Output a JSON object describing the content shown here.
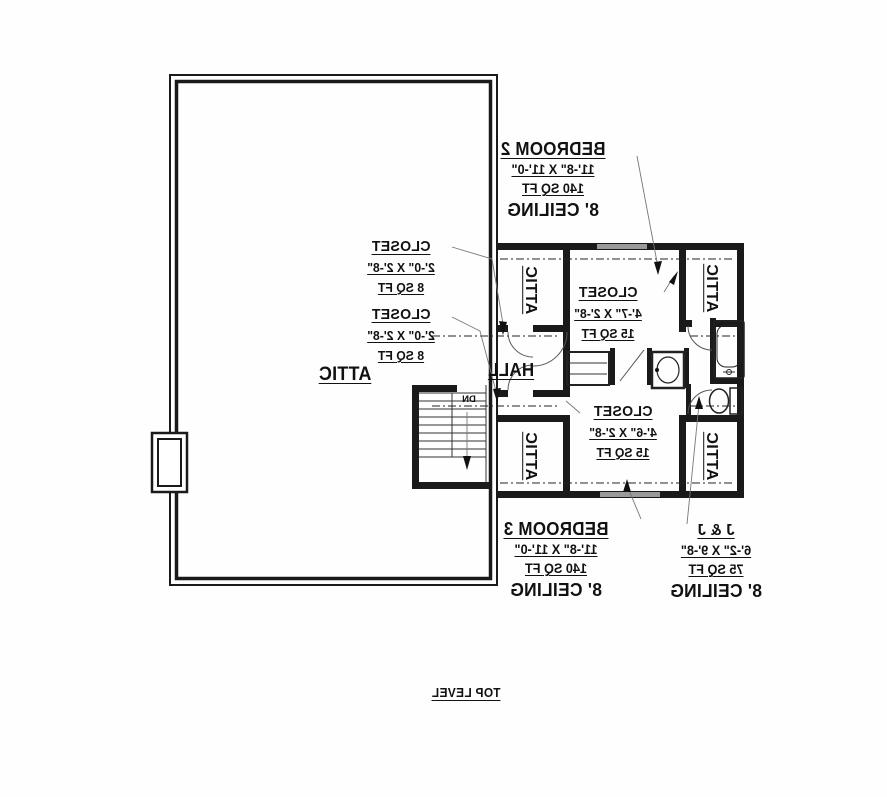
{
  "plan": {
    "title": "TOP LEVEL",
    "rooms": {
      "attic_main": {
        "name": "ATTIC"
      },
      "bedroom2": {
        "name": "BEDROOM 2",
        "dims": "11'-8\" X 11'-0\"",
        "area": "140 SQ FT",
        "ceiling": "8' CEILING"
      },
      "bedroom3": {
        "name": "BEDROOM 3",
        "dims": "11'-8\" X 11'-0\"",
        "area": "140 SQ FT",
        "ceiling": "8' CEILING"
      },
      "jack_and_jill": {
        "name": "J & J",
        "dims": "6'-2\" X 9'-8\"",
        "area": "75 SQ FT",
        "ceiling": "8' CEILING"
      },
      "hall": {
        "name": "HALL"
      },
      "closet_left_upper": {
        "name": "CLOSET",
        "dims": "2'-0\" X 2'-8\"",
        "area": "8 SQ FT"
      },
      "closet_left_lower": {
        "name": "CLOSET",
        "dims": "2'-0\" X 2'-8\"",
        "area": "8 SQ FT"
      },
      "closet_center_upper": {
        "name": "CLOSET",
        "dims": "4'-7\" X 2'-8\"",
        "area": "15 SQ FT"
      },
      "closet_center_lower": {
        "name": "CLOSET",
        "dims": "4'-6\" X 2'-8\"",
        "area": "15 SQ FT"
      },
      "attic_nook_top_left": {
        "name": "ATTIC"
      },
      "attic_nook_top_right": {
        "name": "ATTIC"
      },
      "attic_nook_bottom_left": {
        "name": "ATTIC"
      },
      "attic_nook_bottom_right": {
        "name": "ATTIC"
      }
    },
    "stairs": {
      "label": "DN"
    },
    "colors": {
      "wall": "#1a1a1a",
      "wall_accent": "#9a9a9a",
      "leader": "#777777",
      "background": "#fefefe"
    }
  }
}
